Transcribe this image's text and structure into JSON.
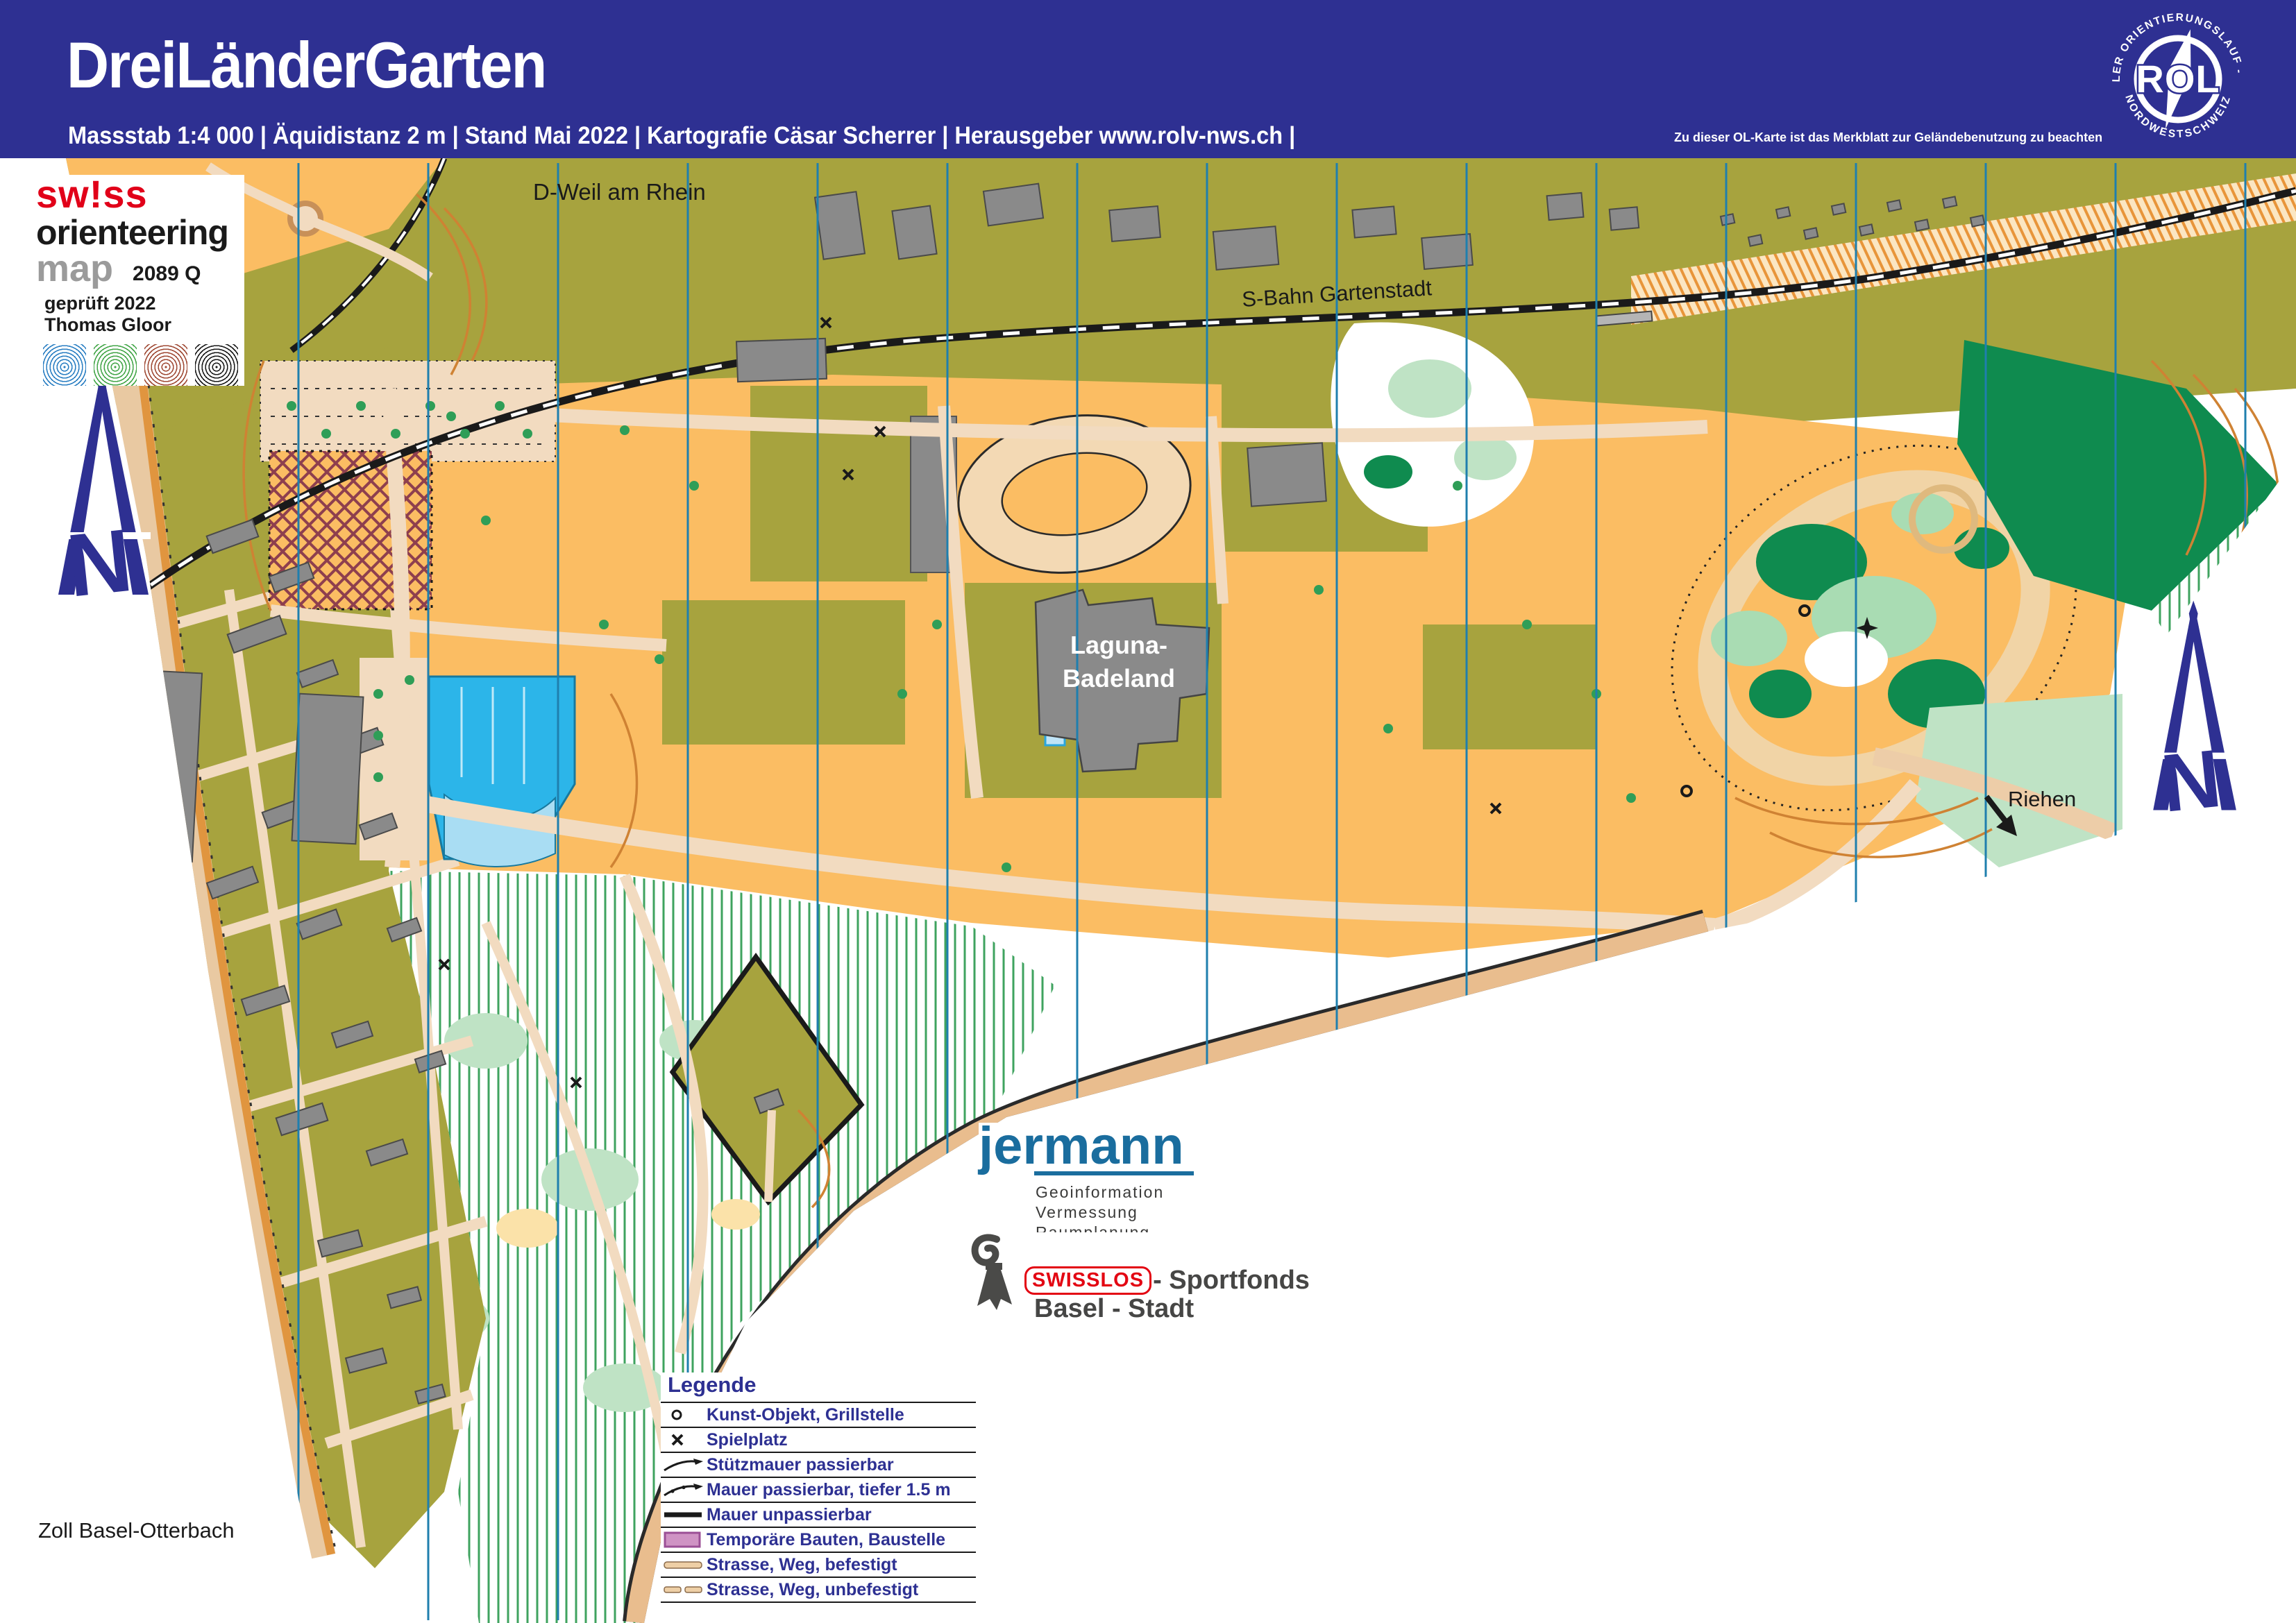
{
  "header": {
    "title": "DreiLänderGarten",
    "subtitle": "Massstab 1:4 000 | Äquidistanz 2 m | Stand Mai 2022 | Kartografie Cäsar Scherrer | Herausgeber www.rolv-nws.ch |",
    "note": "Zu dieser OL-Karte ist das Merkblatt zur Geländebenutzung zu beachten"
  },
  "rol_logo": {
    "text_top": "REGIONALER  ORIENTIERUNGSLAUF - VERBAND",
    "text_bottom": "NORDWESTSCHWEIZ",
    "letters": "ROL"
  },
  "som_logo": {
    "line1": "sw!ss",
    "line2": "orienteering",
    "line3": "map",
    "code": "2089 Q",
    "checked": "geprüft 2022",
    "checker": "Thomas Gloor"
  },
  "north": {
    "letter": "N"
  },
  "map_labels": {
    "weil": "D-Weil am Rhein",
    "sbahn": "S-Bahn Gartenstadt",
    "laguna_line1": "Laguna-",
    "laguna_line2": "Badeland",
    "riehen": "Riehen",
    "zoll": "Zoll Basel-Otterbach"
  },
  "legend": {
    "title": "Legende",
    "items": [
      {
        "symbol": "art-object-icon",
        "label": "Kunst-Objekt, Grillstelle"
      },
      {
        "symbol": "playground-icon",
        "label": "Spielplatz"
      },
      {
        "symbol": "retaining-wall-icon",
        "label": "Stützmauer passierbar"
      },
      {
        "symbol": "wall-passable-icon",
        "label": "Mauer passierbar, tiefer 1.5 m"
      },
      {
        "symbol": "wall-impassable-icon",
        "label": "Mauer unpassierbar"
      },
      {
        "symbol": "temporary-building-swatch",
        "label": "Temporäre Bauten, Baustelle"
      },
      {
        "symbol": "road-paved-icon",
        "label": "Strasse, Weg, befestigt"
      },
      {
        "symbol": "road-unpaved-icon",
        "label": "Strasse, Weg, unbefestigt"
      }
    ]
  },
  "sponsors": {
    "jermann": {
      "name": "jermann",
      "services": [
        "Geoinformation",
        "Vermessung",
        "Raumplanung"
      ]
    },
    "swisslos": {
      "brand": "SWISSLOS",
      "suffix": "- Sportfonds",
      "line2": "Basel - Stadt"
    }
  },
  "colors": {
    "header_blue": "#2e3092",
    "legend_text_blue": "#2d3092",
    "olive_green": "#a7a33e",
    "rough_open_orange": "#fbbd63",
    "paved_beige": "#f2dbc0",
    "building_gray": "#8a8a8a",
    "water_cyan": "#2cb5e9",
    "water_light": "#bfe4f7",
    "forest_dark_green": "#0f8b4f",
    "forest_light_green": "#bfe3c5",
    "contour_brown": "#cf8233",
    "north_line_blue": "#1f7fae",
    "temp_building_pink": "#cf93c4",
    "jermann_teal": "#1a6d9e",
    "swisslos_red": "#e30613"
  }
}
